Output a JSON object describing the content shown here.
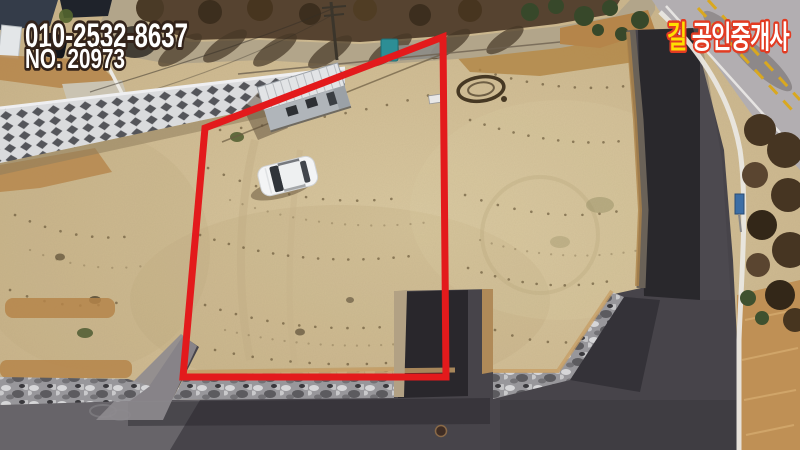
{
  "overlay": {
    "phone": "010-2532-8637",
    "listing_no": "NO. 20973",
    "agency_first": "길",
    "agency_rest": "공인중개사"
  },
  "colors": {
    "boundary_red": "#e31a1c",
    "text_fill": "#ffffff",
    "text_outline": "#33231a",
    "agency_outline": "#e23b22",
    "agency_first_fill": "#ffdf00",
    "sand": "#cdb88f",
    "asphalt_dark": "#2a272c",
    "asphalt_light": "#6f6c70",
    "retaining_wall_white": "#d9dadc",
    "dry_grass_orange": "#b5854a"
  }
}
